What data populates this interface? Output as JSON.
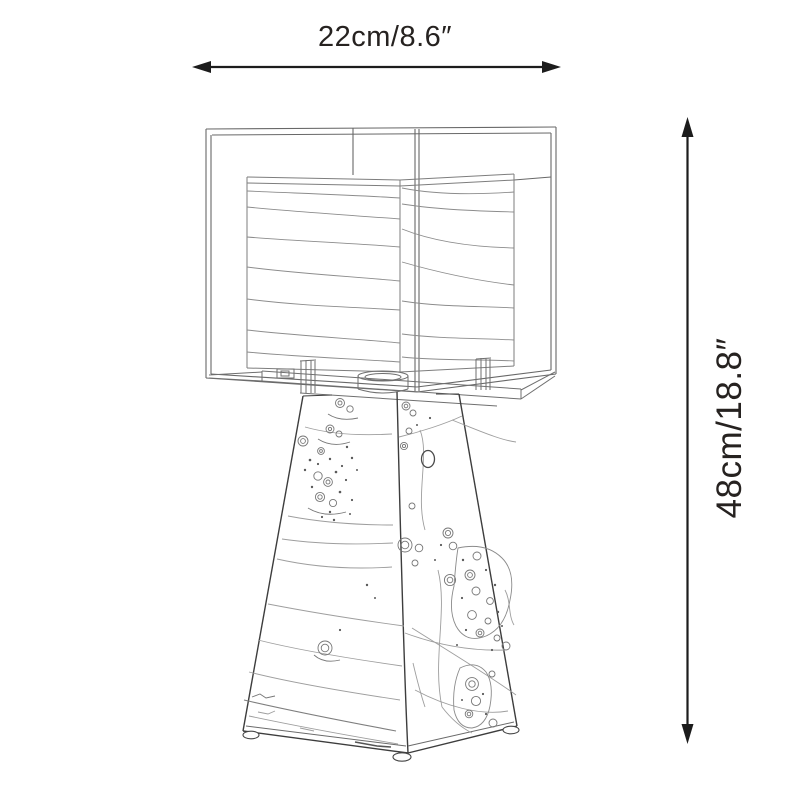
{
  "page": {
    "background": "#ffffff"
  },
  "dimensions": {
    "width": {
      "label": "22cm/8.6″"
    },
    "height": {
      "label": "48cm/18.8″"
    }
  },
  "drawing": {
    "subject": "cube glass shade table lamp on tapered burl-wood pyramid base",
    "style": "monochrome technical line drawing",
    "colors": {
      "arrow": "#1c1c1c",
      "text": "#262220",
      "glass_outline": "#686868",
      "base_outline": "#3d3d3d",
      "shade_lines": "#8c8c8c",
      "wood_grain": "#9e9e9e"
    }
  }
}
